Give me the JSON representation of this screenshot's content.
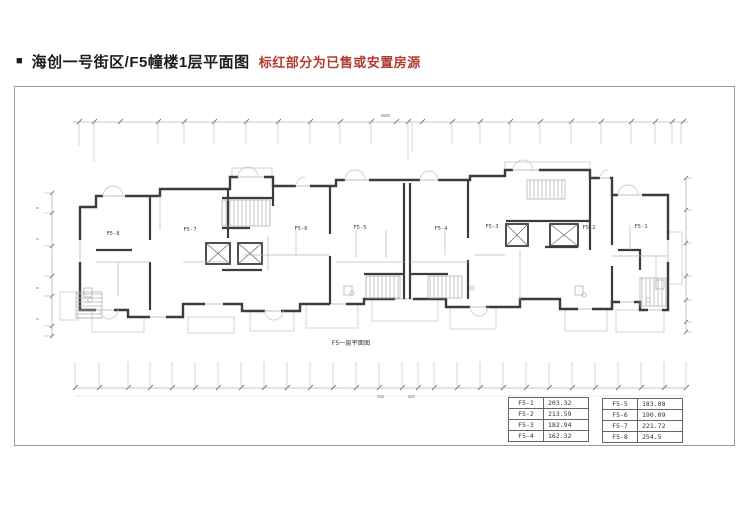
{
  "header": {
    "bullet": "■",
    "title": "海创一号街区/F5幢楼1层平面图",
    "subtitle": "标红部分为已售或安置房源",
    "title_color": "#1c1c1c",
    "subtitle_color": "#b23c31"
  },
  "plan": {
    "caption": "F5一层平面图",
    "unit_labels": [
      "F5-8",
      "F5-7",
      "F5-6",
      "F5-5",
      "F5-4",
      "F5-3",
      "F5-2",
      "F5-1"
    ]
  },
  "tables": {
    "left": {
      "rows": [
        {
          "unit": "F5-1",
          "area": "203.32"
        },
        {
          "unit": "F5-2",
          "area": "213.59"
        },
        {
          "unit": "F5-3",
          "area": "182.94"
        },
        {
          "unit": "F5-4",
          "area": "162.32"
        }
      ]
    },
    "right": {
      "rows": [
        {
          "unit": "F5-5",
          "area": "183.08"
        },
        {
          "unit": "F5-6",
          "area": "190.09"
        },
        {
          "unit": "F5-7",
          "area": "221.72"
        },
        {
          "unit": "F5-8",
          "area": "254.5"
        }
      ]
    }
  }
}
